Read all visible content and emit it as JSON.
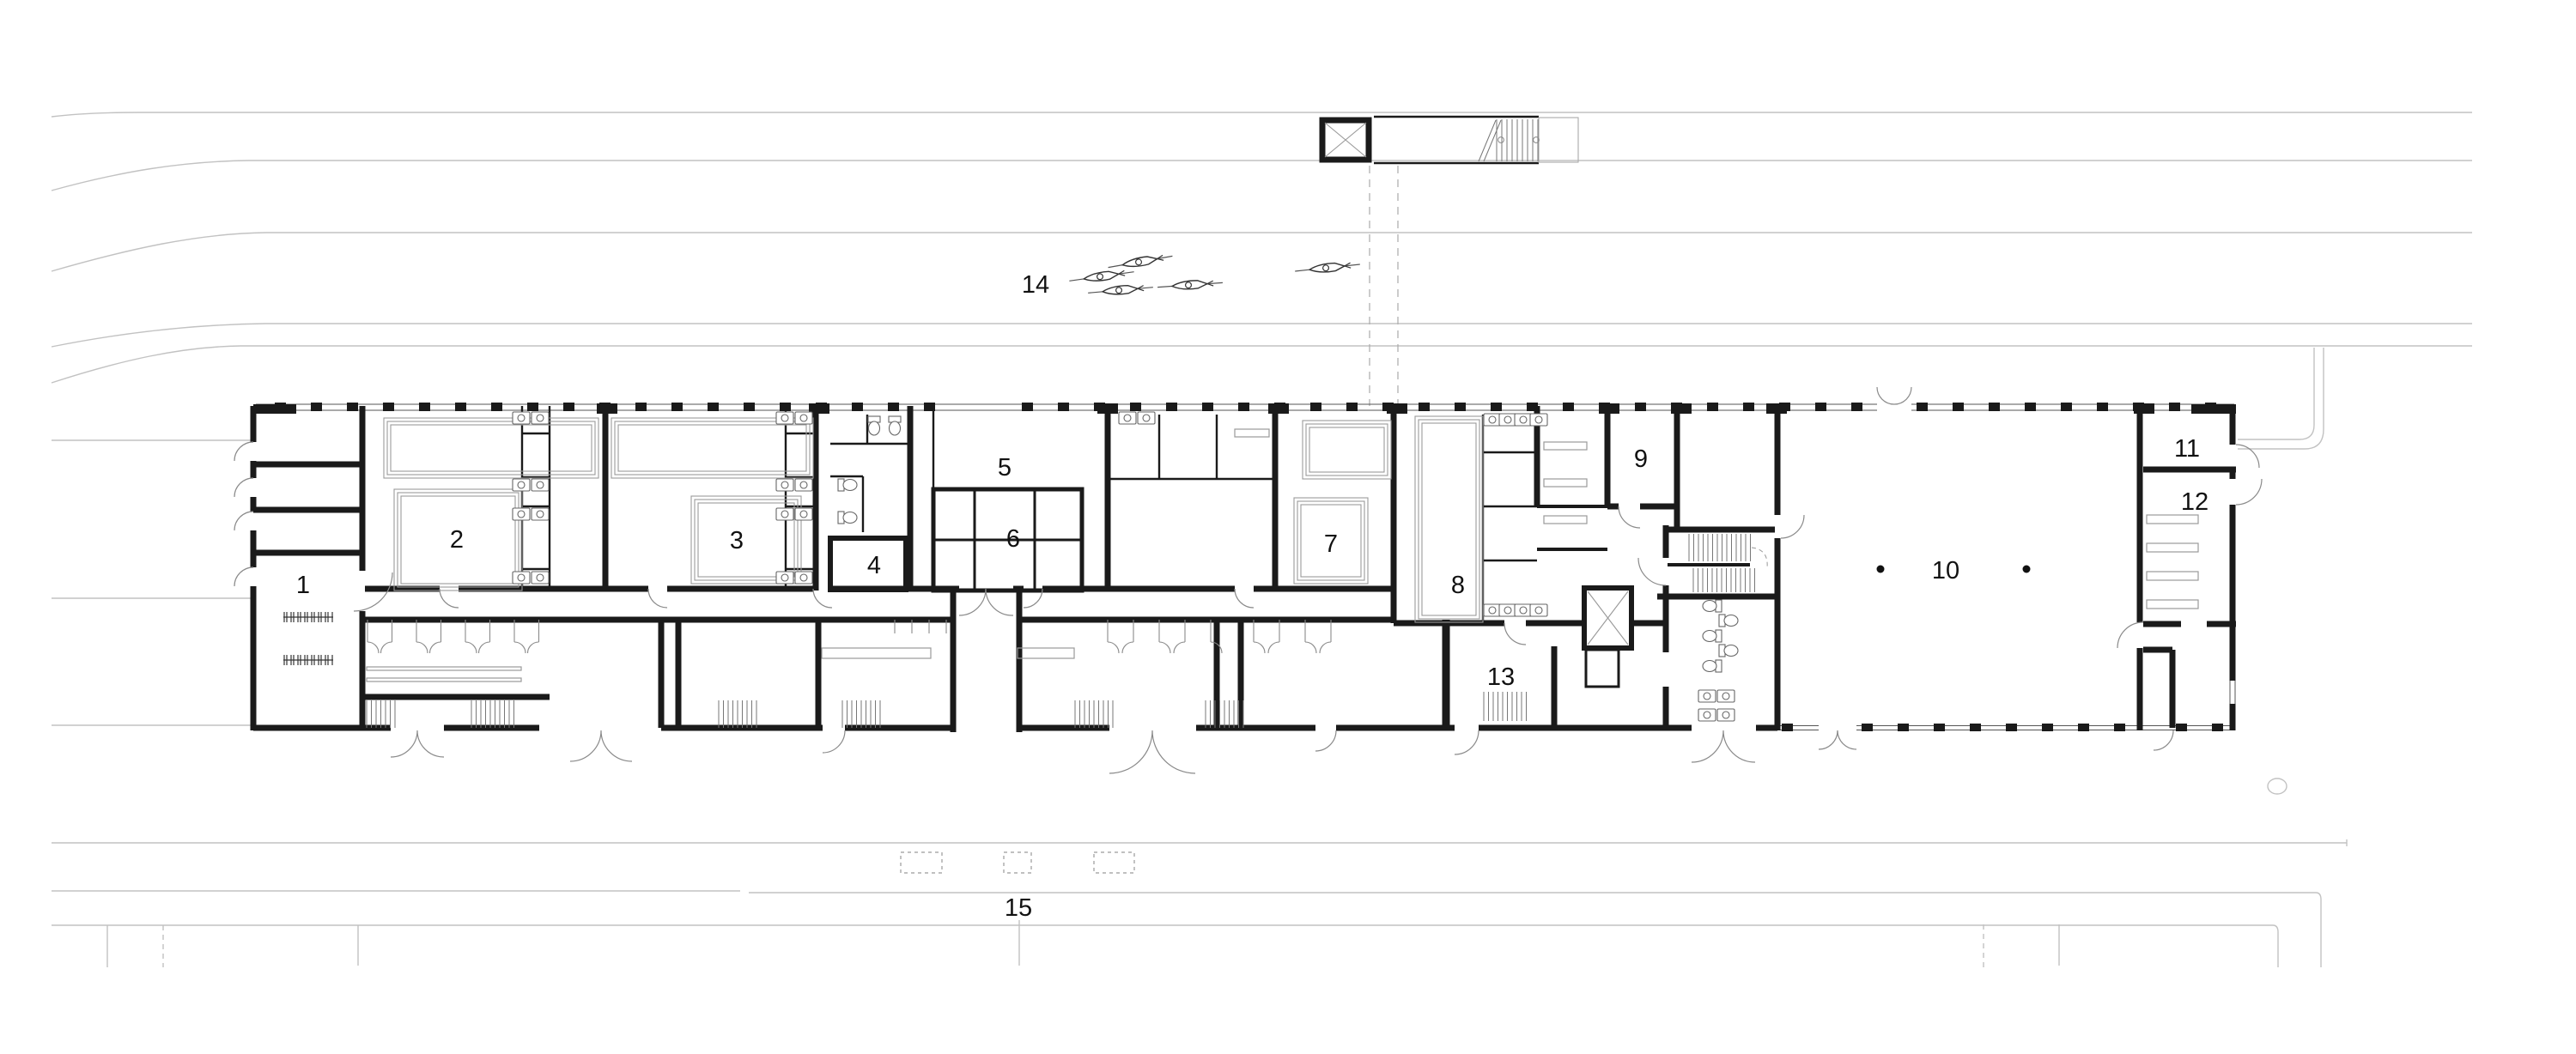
{
  "plan": {
    "labels": [
      "1",
      "2",
      "3",
      "4",
      "5",
      "6",
      "7",
      "8",
      "9",
      "10",
      "11",
      "12",
      "13",
      "14",
      "15"
    ],
    "icon_counts": {
      "boat-icon": 5,
      "column-dot": 2,
      "dashed-parking-bay": 3
    },
    "colors": {
      "wall": "#1a1a1a",
      "site_line": "#c2c2c2",
      "detail": "#8a8a8a"
    }
  }
}
